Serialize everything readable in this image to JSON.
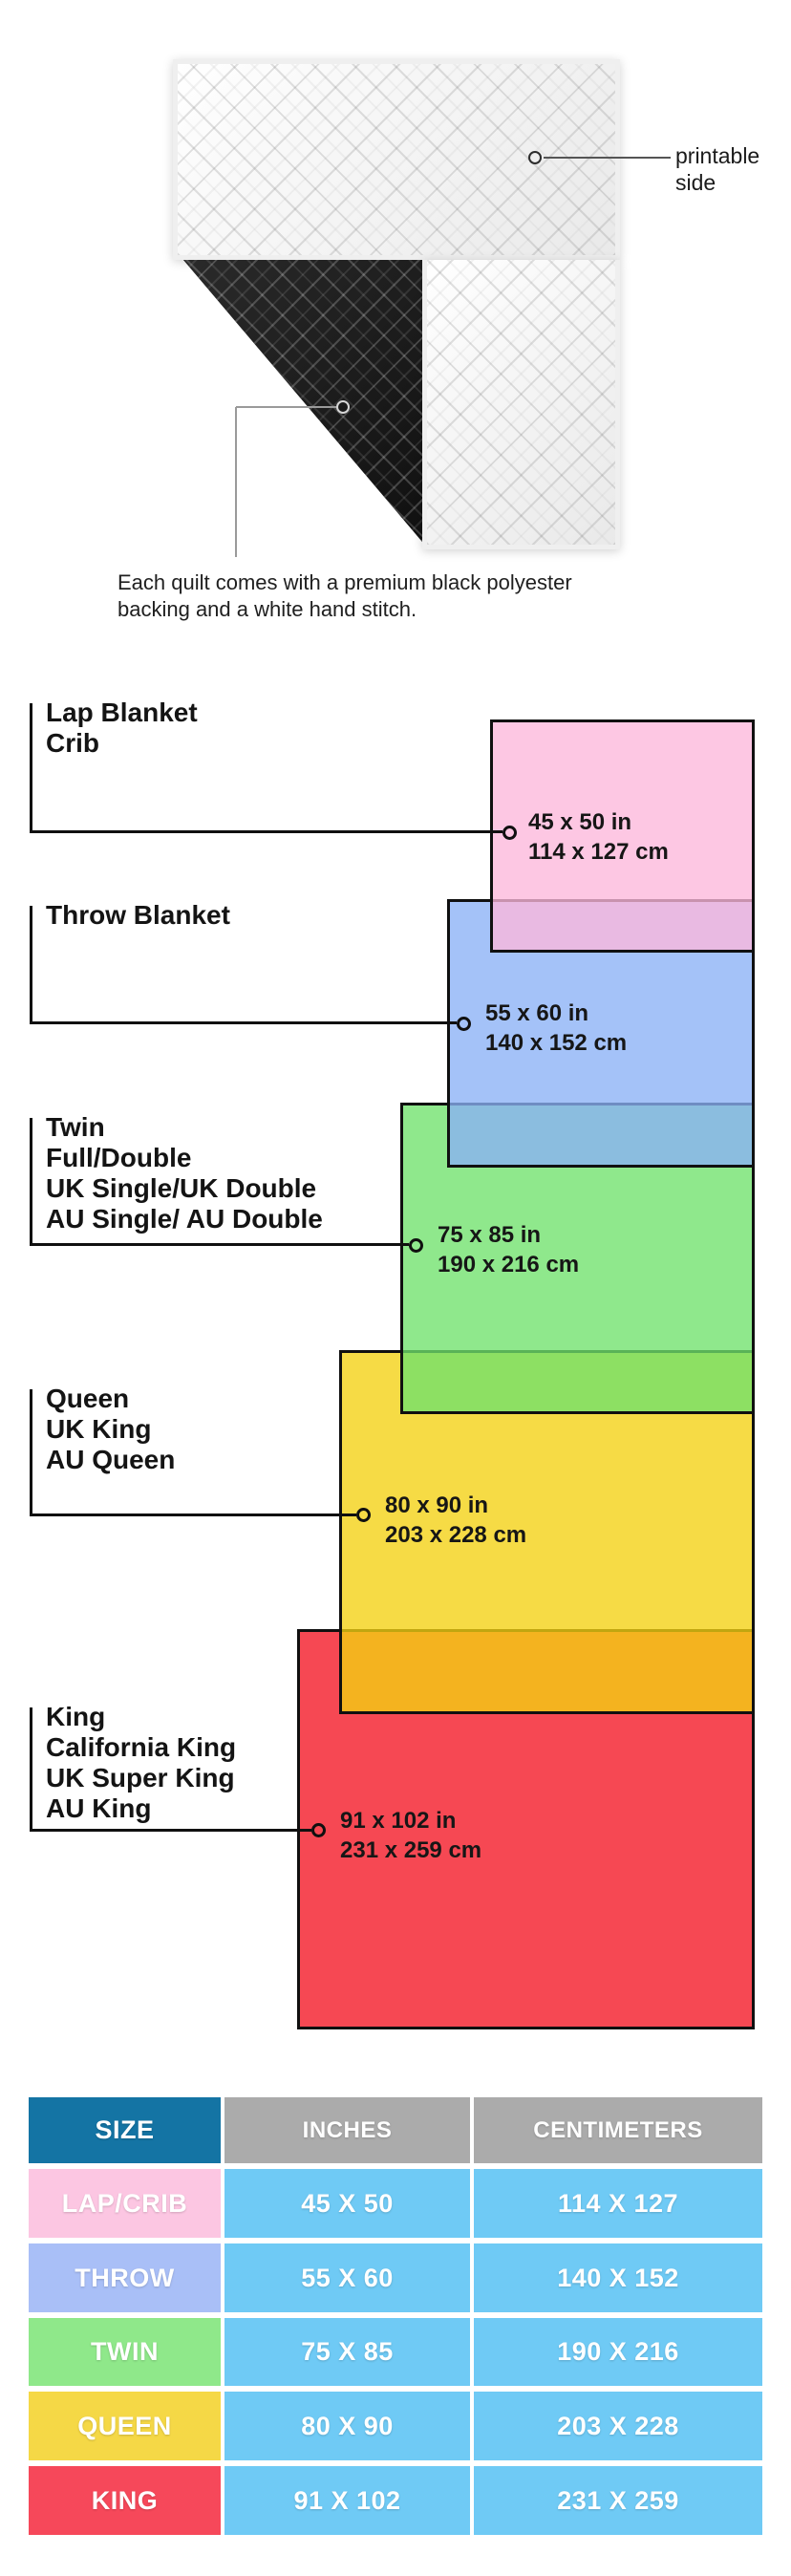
{
  "page": {
    "background": "#FFFFFF"
  },
  "quilt": {
    "printable_label_line1": "printable",
    "printable_label_line2": "side",
    "caption_line1": "Each quilt comes with a premium black polyester",
    "caption_line2": "backing and a white hand stitch."
  },
  "diagram": {
    "items": [
      {
        "names": [
          "Lap Blanket",
          "Crib"
        ],
        "inches": "45 x 50 in",
        "cm": "114 x 127 cm",
        "color": "#FCC7E3",
        "fill": "rgba(252,183,219,0.78)"
      },
      {
        "names": [
          "Throw Blanket"
        ],
        "inches": "55 x 60 in",
        "cm": "140 x 152 cm",
        "color": "#A4C2F8",
        "fill": "rgba(138,177,246,0.78)"
      },
      {
        "names": [
          "Twin",
          "Full/Double",
          "UK Single/UK Double",
          "AU Single/ AU Double"
        ],
        "inches": "75 x 85 in",
        "cm": "190 x 216 cm",
        "color": "#8FE88C",
        "fill": "rgba(112,226,108,0.78)"
      },
      {
        "names": [
          "Queen",
          "UK King",
          "AU Queen"
        ],
        "inches": "80 x 90 in",
        "cm": "203 x 228 cm",
        "color": "#F6DB45",
        "fill": "rgba(244,209,17,0.78)"
      },
      {
        "names": [
          "King",
          "California King",
          "UK Super King",
          "AU King"
        ],
        "inches": "91 x 102 in",
        "cm": "231 x 259 cm",
        "color": "#F64853",
        "fill": "rgba(244,21,35,0.78)"
      }
    ]
  },
  "table": {
    "headers": {
      "size": "SIZE",
      "inches": "INCHES",
      "cm": "CENTIMETERS"
    },
    "header_colors": {
      "size_bg": "#1474A4",
      "metric_bg": "#ABABAB"
    },
    "value_cell_color": "#6FCAF5",
    "rows": [
      {
        "size": "LAP/CRIB",
        "inches": "45 X 50",
        "cm": "114 X 127",
        "color": "#FCC6E2"
      },
      {
        "size": "THROW",
        "inches": "55 X 60",
        "cm": "140 X 152",
        "color": "#A9BFF7"
      },
      {
        "size": "TWIN",
        "inches": "75 X 85",
        "cm": "190 X 216",
        "color": "#8FE88A"
      },
      {
        "size": "QUEEN",
        "inches": "80 X 90",
        "cm": "203 X 228",
        "color": "#F5D846"
      },
      {
        "size": "KING",
        "inches": "91 X 102",
        "cm": "231 X 259",
        "color": "#F6485A"
      }
    ]
  }
}
